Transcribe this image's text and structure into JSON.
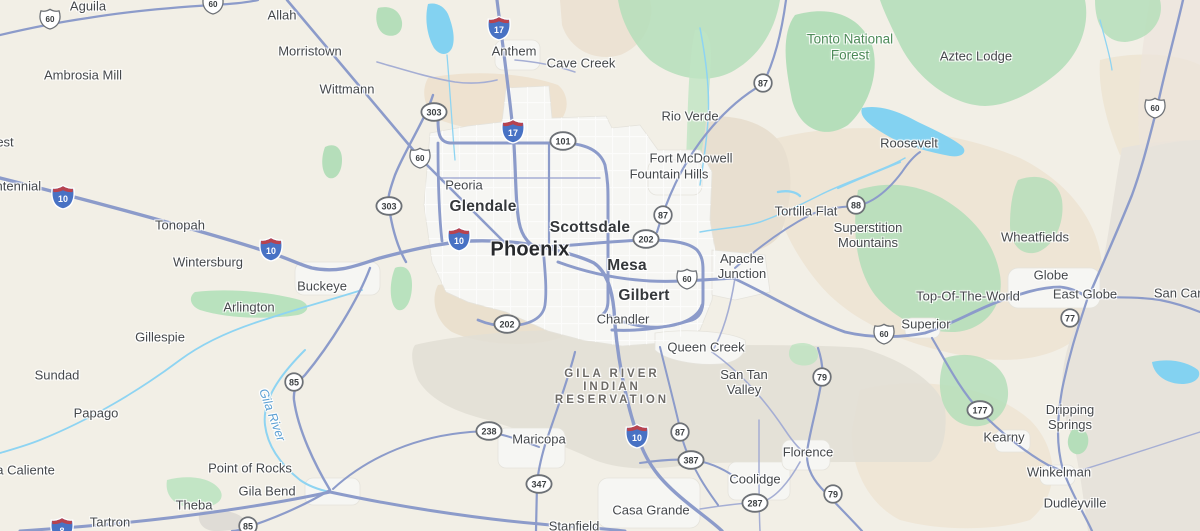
{
  "colors": {
    "land": "#f2efe6",
    "urban": "#f6f6f3",
    "water": "#83d2f1",
    "forest_green": "#b5deba",
    "desert_tan": "#ecdfcb",
    "reservation_gray": "#e3e0d6",
    "highway": "#8c9bca",
    "town_label": "#45484b",
    "forest_label": "#4d8a58",
    "river_label": "#5b9fd3",
    "interstate_blue": "#4872c4",
    "interstate_red": "#b8434f",
    "shield_border": "#6d7176"
  },
  "map": {
    "labels": [
      {
        "text": "Aguila",
        "x": 88,
        "y": 7,
        "kind": "town"
      },
      {
        "text": "Allah",
        "x": 282,
        "y": 16,
        "kind": "town"
      },
      {
        "text": "Morristown",
        "x": 310,
        "y": 52,
        "kind": "town"
      },
      {
        "text": "Ambrosia Mill",
        "x": 83,
        "y": 76,
        "kind": "town"
      },
      {
        "text": "Wittmann",
        "x": 347,
        "y": 90,
        "kind": "town"
      },
      {
        "text": "est",
        "x": 5,
        "y": 143,
        "kind": "town"
      },
      {
        "text": "Centennial",
        "x": 10,
        "y": 187,
        "kind": "town"
      },
      {
        "text": "Anthem",
        "x": 514,
        "y": 52,
        "kind": "town"
      },
      {
        "text": "Cave Creek",
        "x": 581,
        "y": 64,
        "kind": "town"
      },
      {
        "text": "Rio Verde",
        "x": 690,
        "y": 117,
        "kind": "town"
      },
      {
        "text": "Fort McDowell",
        "x": 691,
        "y": 159,
        "kind": "town"
      },
      {
        "text": "Fountain Hills",
        "x": 669,
        "y": 175,
        "kind": "town"
      },
      {
        "lines": [
          "Tonto National",
          "Forest"
        ],
        "x": 850,
        "y": 47,
        "kind": "forest"
      },
      {
        "text": "Aztec Lodge",
        "x": 976,
        "y": 57,
        "kind": "town"
      },
      {
        "text": "Roosevelt",
        "x": 909,
        "y": 144,
        "kind": "town"
      },
      {
        "text": "Peoria",
        "x": 464,
        "y": 186,
        "kind": "town"
      },
      {
        "text": "Glendale",
        "x": 483,
        "y": 207,
        "kind": "city"
      },
      {
        "text": "Scottsdale",
        "x": 590,
        "y": 228,
        "kind": "city"
      },
      {
        "text": "Phoenix",
        "x": 530,
        "y": 250,
        "kind": "city-lg"
      },
      {
        "text": "Tonopah",
        "x": 180,
        "y": 226,
        "kind": "town"
      },
      {
        "text": "Wintersburg",
        "x": 208,
        "y": 263,
        "kind": "town"
      },
      {
        "text": "Mesa",
        "x": 627,
        "y": 266,
        "kind": "city"
      },
      {
        "text": "Gilbert",
        "x": 644,
        "y": 296,
        "kind": "city"
      },
      {
        "text": "Chandler",
        "x": 623,
        "y": 320,
        "kind": "town"
      },
      {
        "lines": [
          "Apache",
          "Junction"
        ],
        "x": 742,
        "y": 267,
        "kind": "town"
      },
      {
        "text": "Tortilla Flat",
        "x": 806,
        "y": 212,
        "kind": "town"
      },
      {
        "lines": [
          "Superstition",
          "Mountains"
        ],
        "x": 868,
        "y": 236,
        "kind": "town"
      },
      {
        "text": "Wheatfields",
        "x": 1035,
        "y": 238,
        "kind": "town"
      },
      {
        "text": "Globe",
        "x": 1051,
        "y": 276,
        "kind": "town"
      },
      {
        "text": "East Globe",
        "x": 1085,
        "y": 295,
        "kind": "town"
      },
      {
        "text": "San Carlos",
        "x": 1186,
        "y": 294,
        "kind": "town"
      },
      {
        "text": "Top-Of-The-World",
        "x": 968,
        "y": 297,
        "kind": "town"
      },
      {
        "text": "Superior",
        "x": 926,
        "y": 325,
        "kind": "town"
      },
      {
        "text": "Buckeye",
        "x": 322,
        "y": 287,
        "kind": "town"
      },
      {
        "text": "Arlington",
        "x": 249,
        "y": 308,
        "kind": "town"
      },
      {
        "text": "Gillespie",
        "x": 160,
        "y": 338,
        "kind": "town"
      },
      {
        "text": "Sundad",
        "x": 57,
        "y": 376,
        "kind": "town"
      },
      {
        "text": "Papago",
        "x": 96,
        "y": 414,
        "kind": "town"
      },
      {
        "text": "Agua Caliente",
        "x": 14,
        "y": 471,
        "kind": "town"
      },
      {
        "text": "Queen Creek",
        "x": 706,
        "y": 348,
        "kind": "town"
      },
      {
        "lines": [
          "San Tan",
          "Valley"
        ],
        "x": 744,
        "y": 383,
        "kind": "town"
      },
      {
        "lines": [
          "GILA RIVER",
          "INDIAN",
          "RESERVATION"
        ],
        "x": 612,
        "y": 388,
        "kind": "reservation"
      },
      {
        "text": "Maricopa",
        "x": 539,
        "y": 440,
        "kind": "town"
      },
      {
        "text": "Coolidge",
        "x": 755,
        "y": 480,
        "kind": "town"
      },
      {
        "text": "Casa Grande",
        "x": 651,
        "y": 511,
        "kind": "town"
      },
      {
        "text": "Stanfield",
        "x": 574,
        "y": 527,
        "kind": "town"
      },
      {
        "text": "Florence",
        "x": 808,
        "y": 453,
        "kind": "town"
      },
      {
        "text": "Kearny",
        "x": 1004,
        "y": 438,
        "kind": "town"
      },
      {
        "lines": [
          "Dripping",
          "Springs"
        ],
        "x": 1070,
        "y": 418,
        "kind": "town"
      },
      {
        "text": "Winkelman",
        "x": 1059,
        "y": 473,
        "kind": "town"
      },
      {
        "text": "Dudleyville",
        "x": 1075,
        "y": 504,
        "kind": "town"
      },
      {
        "text": "Point of Rocks",
        "x": 250,
        "y": 469,
        "kind": "town"
      },
      {
        "text": "Gila Bend",
        "x": 267,
        "y": 492,
        "kind": "town"
      },
      {
        "text": "Theba",
        "x": 194,
        "y": 506,
        "kind": "town"
      },
      {
        "text": "Tartron",
        "x": 110,
        "y": 523,
        "kind": "town"
      }
    ],
    "river_label": {
      "text": "Gila River",
      "x": 272,
      "y": 415,
      "rotation": 70
    },
    "shields": [
      {
        "type": "us",
        "num": "60",
        "x": 50,
        "y": 19
      },
      {
        "type": "us",
        "num": "60",
        "x": 213,
        "y": 4
      },
      {
        "type": "interstate",
        "num": "17",
        "x": 499,
        "y": 28
      },
      {
        "type": "circle",
        "num": "87",
        "x": 763,
        "y": 83
      },
      {
        "type": "us",
        "num": "60",
        "x": 1155,
        "y": 108
      },
      {
        "type": "ellipse",
        "num": "303",
        "x": 434,
        "y": 112
      },
      {
        "type": "interstate",
        "num": "17",
        "x": 513,
        "y": 131
      },
      {
        "type": "ellipse",
        "num": "101",
        "x": 563,
        "y": 141
      },
      {
        "type": "us",
        "num": "60",
        "x": 420,
        "y": 158
      },
      {
        "type": "interstate",
        "num": "10",
        "x": 63,
        "y": 197
      },
      {
        "type": "ellipse",
        "num": "303",
        "x": 389,
        "y": 206
      },
      {
        "type": "circle",
        "num": "88",
        "x": 856,
        "y": 205
      },
      {
        "type": "circle",
        "num": "87",
        "x": 663,
        "y": 215
      },
      {
        "type": "ellipse",
        "num": "202",
        "x": 646,
        "y": 239
      },
      {
        "type": "interstate",
        "num": "10",
        "x": 271,
        "y": 249
      },
      {
        "type": "interstate",
        "num": "10",
        "x": 459,
        "y": 239
      },
      {
        "type": "us",
        "num": "60",
        "x": 687,
        "y": 279
      },
      {
        "type": "ellipse",
        "num": "202",
        "x": 507,
        "y": 324
      },
      {
        "type": "circle",
        "num": "77",
        "x": 1070,
        "y": 318
      },
      {
        "type": "us",
        "num": "60",
        "x": 884,
        "y": 334
      },
      {
        "type": "circle",
        "num": "79",
        "x": 822,
        "y": 377
      },
      {
        "type": "circle",
        "num": "85",
        "x": 294,
        "y": 382
      },
      {
        "type": "ellipse",
        "num": "177",
        "x": 980,
        "y": 410
      },
      {
        "type": "ellipse",
        "num": "238",
        "x": 489,
        "y": 431
      },
      {
        "type": "circle",
        "num": "87",
        "x": 680,
        "y": 432
      },
      {
        "type": "interstate",
        "num": "10",
        "x": 637,
        "y": 436
      },
      {
        "type": "ellipse",
        "num": "387",
        "x": 691,
        "y": 460
      },
      {
        "type": "ellipse",
        "num": "347",
        "x": 539,
        "y": 484
      },
      {
        "type": "circle",
        "num": "79",
        "x": 833,
        "y": 494
      },
      {
        "type": "ellipse",
        "num": "287",
        "x": 755,
        "y": 503
      },
      {
        "type": "circle",
        "num": "85",
        "x": 248,
        "y": 526
      },
      {
        "type": "interstate",
        "num": "8",
        "x": 62,
        "y": 529
      }
    ]
  }
}
